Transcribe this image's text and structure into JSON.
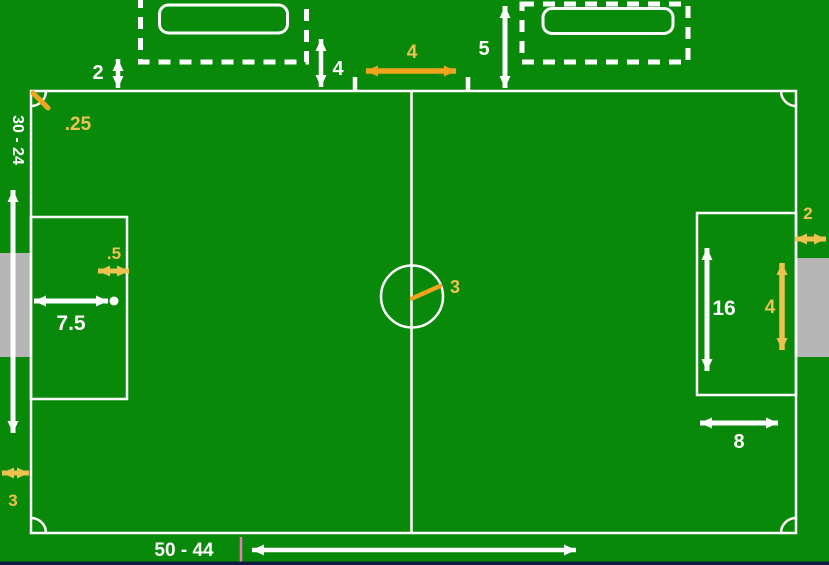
{
  "diagram_type": "soccer-field-dimensions",
  "colors": {
    "field_green": "#098909",
    "line_white": "#ffffff",
    "goal_gray": "#b5b5b5",
    "gold": "#eec24f",
    "amber": "#f2a41c",
    "pink_tick": "#e87ab8",
    "bottom_strip": "#0e1c3d"
  },
  "dims": {
    "bench_gap": "2",
    "left_bench_offset": "4",
    "center_gap": "4",
    "right_bench_offset": "5",
    "field_width_range": "30 - 24",
    "corner_arc_radius": ".25",
    "spot_edge_offset": ".5",
    "penalty_spot_distance": "7.5",
    "left_goal_depth": "3",
    "center_circle_radius": "3",
    "penalty_area_length": "16",
    "right_goal_width": "4",
    "right_goal_depth": "2",
    "penalty_area_depth": "8",
    "field_length_range": "50 - 44"
  }
}
